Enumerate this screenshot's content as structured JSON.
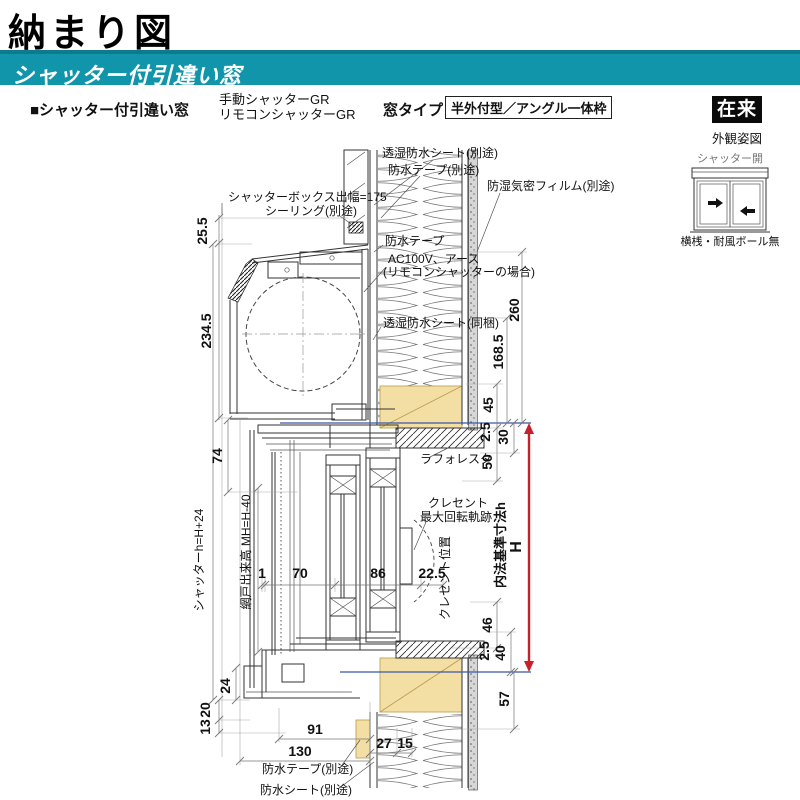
{
  "title": "納まり図",
  "banner": {
    "label": "シャッター付引違い窓"
  },
  "header": {
    "product": "■シャッター付引違い窓",
    "shutter_manual": "手動シャッターGR",
    "shutter_remote": "リモコンシャッターGR",
    "window_type_label": "窓タイプ",
    "window_type_value": "半外付型／アングル一体枠",
    "method_badge": "在来",
    "appearance_caption": "外観姿図"
  },
  "appearance": {
    "state_label": "シャッター開",
    "note": "横桟・耐風ボール無"
  },
  "callouts": {
    "sheet_top": "透湿防水シート(別途)",
    "tape_top": "防水テープ(別途)",
    "film": "防湿気密フィルム(別途)",
    "box_width": "シャッターボックス出幅=175",
    "sealing": "シーリング(別途)",
    "tape_mid": "防水テープ",
    "power1": "AC100V、アース",
    "power2": "(リモコンシャッターの場合)",
    "sheet_mid": "透湿防水シート(同梱)",
    "laforesta": "ラフォレスタ",
    "crescent1": "クレセント",
    "crescent2": "最大回転軌跡",
    "crescent_pos": "クレセント位置",
    "inner_std": "内法基準寸法h",
    "inner_H": "H",
    "shutter_formula": "シャッターh=H+24",
    "screen_formula": "網戸出来高 MH=H-40",
    "tape_bottom": "防水テープ(別途)",
    "sheet_bottom": "防水シート(別途)"
  },
  "dims": {
    "left": {
      "a": "25.5",
      "b": "234.5",
      "c": "74",
      "d": "24",
      "e": "20",
      "f": "13"
    },
    "mid": {
      "a": "1",
      "b": "70",
      "c": "86",
      "d": "22.5"
    },
    "bottom": {
      "a": "91",
      "b": "130",
      "c": "27",
      "d": "15"
    },
    "right": {
      "a": "260",
      "b": "168.5",
      "c": "45",
      "d": "2.5",
      "e": "30",
      "f": "50",
      "g": "46",
      "h": "2.5",
      "i": "40",
      "j": "57"
    }
  },
  "colors": {
    "banner_teal": "#1195ab",
    "wood_fill": "#f3dfa3",
    "datum_red": "#c8202a",
    "datum_blue": "#3a57a8"
  }
}
